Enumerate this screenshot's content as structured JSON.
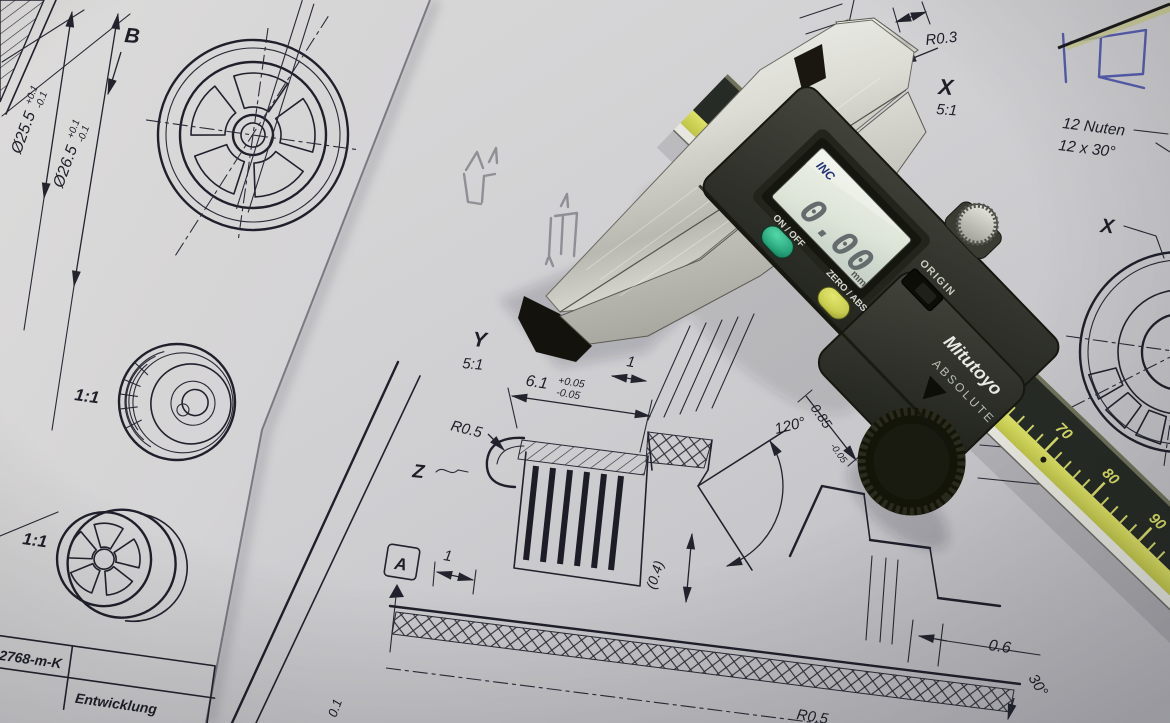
{
  "left_sheet": {
    "dims": {
      "d1_value": "Ø25.5",
      "d1_tol_plus": "+0.1",
      "d1_tol_minus": "-0.1",
      "d2_value": "Ø26.5",
      "d2_tol_plus": "+0.1",
      "d2_tol_minus": "-0.1"
    },
    "view_arrow_label": "B",
    "scale_label_top": "1:1",
    "scale_label_bottom": "1:1",
    "title_block": {
      "tolerance_note": "en nach DIN ISO 2768-m-K",
      "stage_label": "Entwicklung"
    }
  },
  "right_sheet": {
    "detail_x": {
      "radius_label": "R0.3",
      "view_label": "X",
      "view_scale": "5:1"
    },
    "nuten_note_line1": "12 Nuten",
    "nuten_note_line2": "12 x 30°",
    "section_ref_label": "X",
    "detail_y": {
      "view_label": "Y",
      "view_scale": "5:1"
    },
    "dims": {
      "width_value": "6.1",
      "width_tol_plus": "+0.05",
      "width_tol_minus": "-0.05",
      "slot_top": "1",
      "radius_top": "R0.5",
      "profile_ref": "Z",
      "slot_left": "1",
      "cone_angle": "120°",
      "depth_value": "0.85",
      "depth_tol": "-0.05",
      "groove_width": "(0.4)",
      "datum_label": "A",
      "step_width": "0.6",
      "chamfer_angle": "30°",
      "radius_bottom": "R0.5",
      "partial_tol": "0.1"
    }
  },
  "caliper": {
    "brand": "Mitutoyo",
    "series": "ABSOLUTE",
    "lcd": {
      "mode_indicator": "INC",
      "reading": "0.00",
      "unit": "mm"
    },
    "buttons": {
      "power": "ON / OFF",
      "zero": "ZERO / ABS",
      "origin": "ORIGIN"
    },
    "main_scale": {
      "zero_mark": "0",
      "tick_70": "70",
      "tick_80": "80",
      "tick_90": "90"
    }
  },
  "colors": {
    "paper_right": "#cfcfd2",
    "paper_left": "#d8d7d8",
    "ink": "#22222e",
    "blue_pen": "#575eae",
    "pencil": "#83838b",
    "caliper_body": "#31332c",
    "lcd_screen": "#e2e8dd",
    "button_green": "#2aa87e",
    "button_yellow": "#c9cd4e",
    "scale_yellow": "#d5d968",
    "jaw_metal": "#d9d9d3"
  }
}
